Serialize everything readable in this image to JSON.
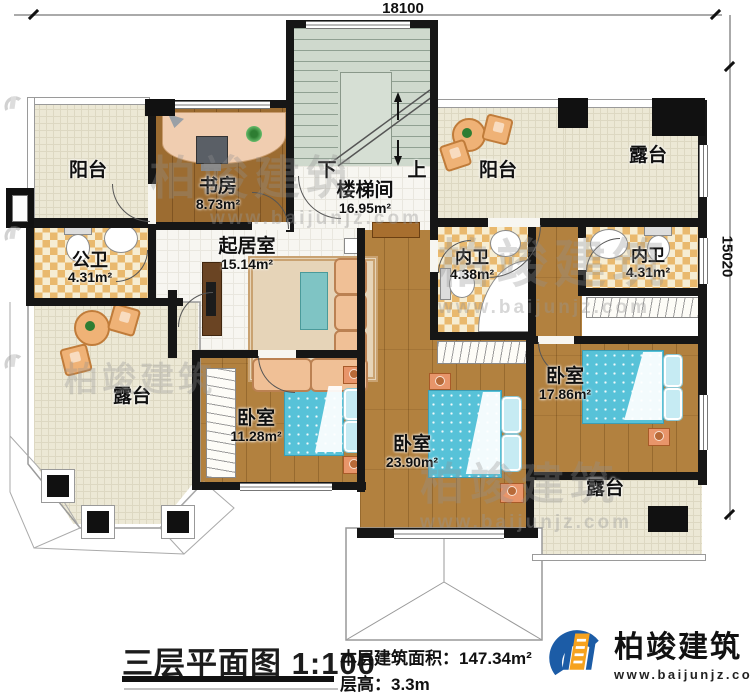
{
  "dimensions": {
    "width": "18100",
    "height": "15020"
  },
  "rooms": {
    "balcony_tl": {
      "label": "阳台"
    },
    "study": {
      "label": "书房",
      "area": "8.73m²"
    },
    "stairwell": {
      "label": "楼梯间",
      "area": "16.95m²"
    },
    "balcony_tr": {
      "label": "阳台"
    },
    "terrace_tr": {
      "label": "露台"
    },
    "public_bath": {
      "label": "公卫",
      "area": "4.31m²"
    },
    "living": {
      "label": "起居室",
      "area": "15.14m²"
    },
    "bath_left": {
      "label": "内卫",
      "area": "4.38m²"
    },
    "bath_right": {
      "label": "内卫",
      "area": "4.31m²"
    },
    "terrace_bl": {
      "label": "露台"
    },
    "bedroom_1": {
      "label": "卧室",
      "area": "11.28m²"
    },
    "bedroom_2": {
      "label": "卧室",
      "area": "23.90m²"
    },
    "bedroom_3": {
      "label": "卧室",
      "area": "17.86m²"
    },
    "terrace_br": {
      "label": "露台"
    }
  },
  "stairs": {
    "down": "下",
    "up": "上"
  },
  "footer": {
    "title": "三层平面图",
    "scale": "1:100",
    "area_label": "本层建筑面积：",
    "area_value": "147.34m²",
    "height_label": "层高：",
    "height_value": "3.3m"
  },
  "brand": {
    "name": "柏竣建筑",
    "website": "www.baijunjz.com"
  },
  "watermark": {
    "name": "柏竣建筑",
    "website": "www.baijunjz.com"
  },
  "colors": {
    "wall": "#161616",
    "wood": "#b2813f",
    "tile": "#ece8d5",
    "checker_dark": "#e9b96e",
    "bed": "#57c2d8",
    "brand_blue": "#1c5ca6",
    "brand_orange": "#f6a21e"
  }
}
